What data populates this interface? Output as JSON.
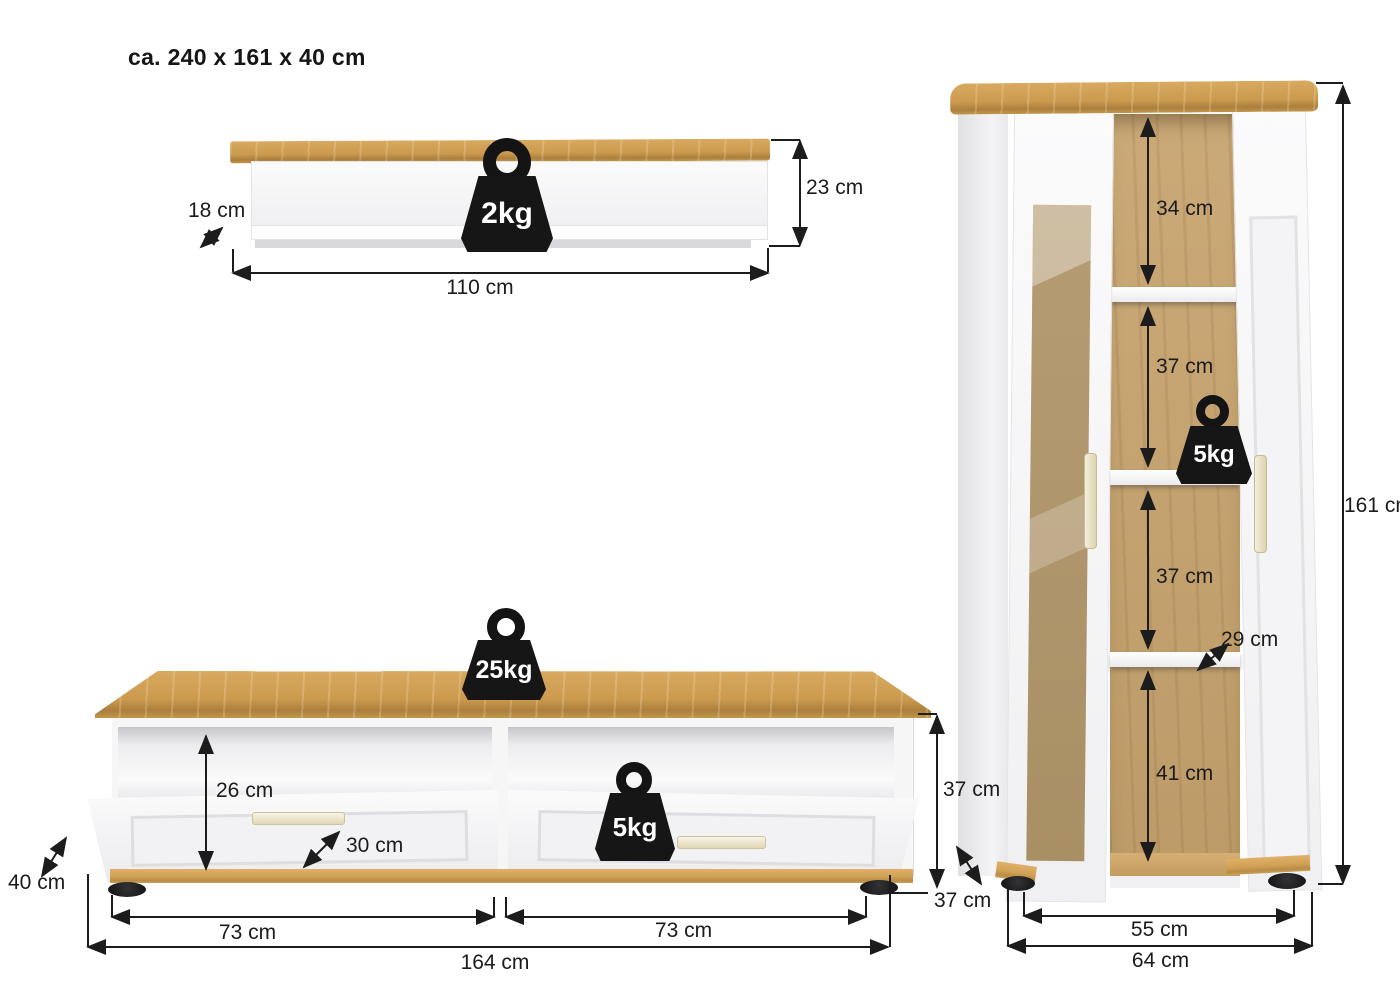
{
  "title": "ca. 240 x 161 x 40 cm",
  "units": "cm",
  "colors": {
    "wood": "#cd9c53",
    "wood_light": "#dfb168",
    "wood_dark": "#aa7f3e",
    "interior_wood": "#c3a271",
    "furniture_white": "#f6f6f7",
    "dimension_line": "#1c1c1c",
    "weight_black": "#141414",
    "handle_cream": "#e9e2c8",
    "background": "#ffffff"
  },
  "wall_shelf": {
    "max_load": "2kg",
    "depth": "18 cm",
    "width": "110 cm",
    "height": "23 cm"
  },
  "tv_lowboard": {
    "max_load_top": "25kg",
    "max_load_drawer": "5kg",
    "open_compartment_height": "26 cm",
    "open_compartment_depth": "30 cm",
    "depth": "40 cm",
    "carcass_height": "37 cm",
    "left_drawer_width": "73 cm",
    "right_drawer_width": "73 cm",
    "total_width": "164 cm"
  },
  "display_cabinet": {
    "max_load_shelf": "5kg",
    "compartment_1_height": "34 cm",
    "compartment_2_height": "37 cm",
    "compartment_3_height": "37 cm",
    "shelf_depth": "29 cm",
    "compartment_4_height": "41 cm",
    "height": "161 cm",
    "side_depth": "37 cm",
    "inner_width": "55 cm",
    "total_width": "64 cm"
  }
}
